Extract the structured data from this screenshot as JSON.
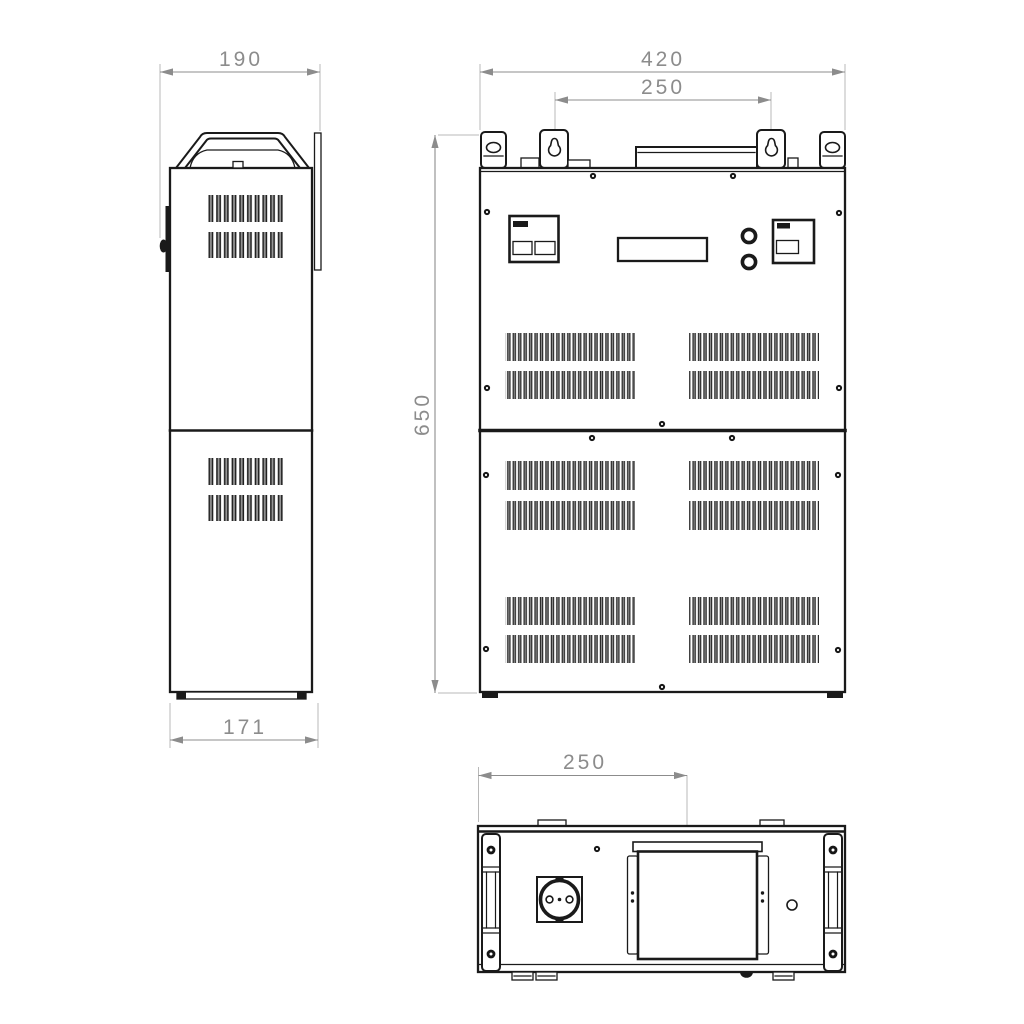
{
  "drawing": {
    "background": "#ffffff",
    "line_color": "#1a1a1a",
    "dimension_color": "#8c8c8c",
    "views": {
      "side": {
        "dimensions": {
          "width": "190",
          "depth": "171"
        }
      },
      "front": {
        "dimensions": {
          "width": "420",
          "mount_span": "250",
          "height": "650"
        }
      },
      "bottom": {
        "dimensions": {
          "terminal_offset": "250"
        }
      }
    }
  }
}
